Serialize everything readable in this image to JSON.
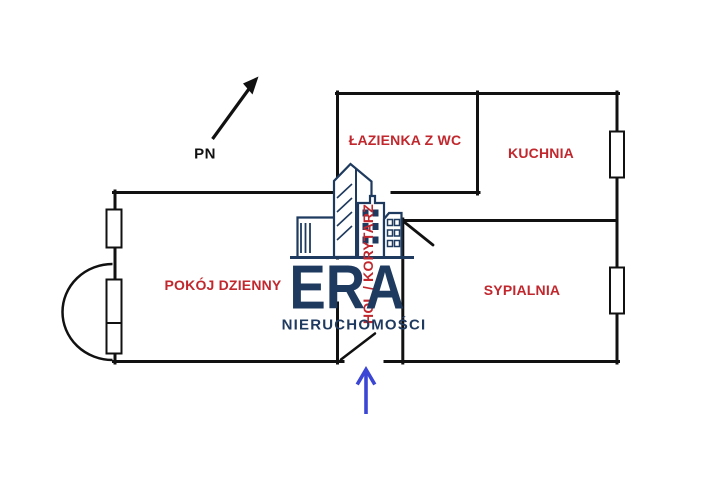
{
  "plan": {
    "compass": {
      "label": "PN"
    },
    "rooms": {
      "lazienka": {
        "label": "ŁAZIENKA Z WC"
      },
      "kuchnia": {
        "label": "KUCHNIA"
      },
      "pokoj_dzienny": {
        "label": "POKÓJ DZIENNY"
      },
      "sypialnia": {
        "label": "SYPIALNIA"
      },
      "hol": {
        "label": "HOL / KORYTARZ"
      }
    },
    "colors": {
      "walls": "#111111",
      "room_labels": "#c1272d",
      "entrance_arrow": "#3b46d4",
      "watermark": "#1e3a5f"
    }
  },
  "watermark": {
    "brand": "ERA",
    "subtitle": "NIERUCHOMOŚCI"
  }
}
